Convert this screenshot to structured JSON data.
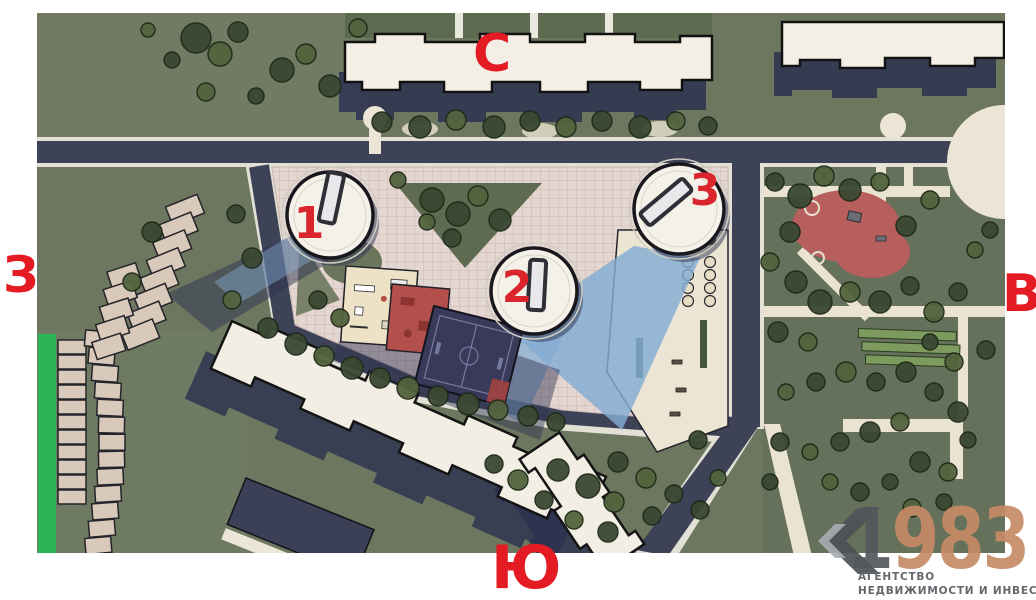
{
  "compass": {
    "north_label": "С",
    "south_label": "Ю",
    "west_label": "З",
    "east_label": "В"
  },
  "towers": {
    "tower1_label": "1",
    "tower2_label": "2",
    "tower3_label": "3"
  },
  "watermark": {
    "year_prefix": "1",
    "year_suffix": "983",
    "agency_line1": "АГЕНТСТВО",
    "agency_line2": "НЕДВИЖИМОСТИ И ИНВЕСТИЦИЙ"
  },
  "colors": {
    "compass_red": "#e41b22",
    "tower_number_red": "#d9252b",
    "watermark_gray": "#54585d",
    "watermark_accent": "#c68a67",
    "watermark_caption_gray": "#63676b",
    "grass": "#6d7760",
    "road": "#3e4257",
    "roof_cream": "#f4efe5",
    "glass_shadow_blue": "#83acd3",
    "shadow_navy": "#2c3150",
    "accent_green_strip": "#2db457",
    "pavement_pink": "#e4d7d2"
  }
}
